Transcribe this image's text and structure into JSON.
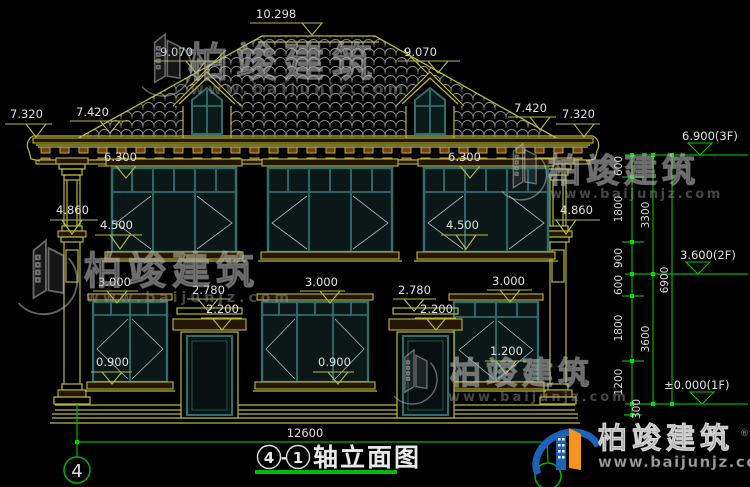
{
  "watermarks": {
    "brand": "柏竣建筑",
    "site": "www.baijunjz.com"
  },
  "logo": {
    "brand": "柏竣建筑",
    "site": "www.baijunjz.com",
    "reg": "®"
  },
  "title": {
    "axis_start": "4",
    "sep": "-",
    "axis_end": "1",
    "name": "轴立面图"
  },
  "axis": {
    "bubble_left": "4"
  },
  "dims": {
    "ridge": "10.298",
    "slope_l": "9.070",
    "slope_r": "9.070",
    "eave_in_l": "7.420",
    "eave_out_l": "7.320",
    "eave_in_r": "7.420",
    "eave_out_r": "7.320",
    "w2_top_l": "6.300",
    "w2_top_r": "6.300",
    "cap_l": "4.860",
    "cap_r": "4.860",
    "w2_bot_l": "4.500",
    "w2_bot_r": "4.500",
    "w1_top_1": "3.000",
    "w1_top_2": "3.000",
    "w1_top_3": "3.000",
    "door_top_1": "2.780",
    "door_top_2": "2.780",
    "door_leaf_1": "2.200",
    "door_leaf_2": "2.200",
    "sill_1": "0.900",
    "sill_2": "0.900",
    "sill_3": "1.200",
    "level_3f": "6.900(3F)",
    "level_2f": "3.600(2F)",
    "level_1f": "±0.000(1F)",
    "total_width": "12600"
  },
  "chain": {
    "c1": "600",
    "c2": "1800",
    "c3": "900",
    "c4": "600",
    "c5": "1800",
    "c6": "1200",
    "c7": "300",
    "t_upper": "3300",
    "t_lower": "3600",
    "total": "6900"
  }
}
